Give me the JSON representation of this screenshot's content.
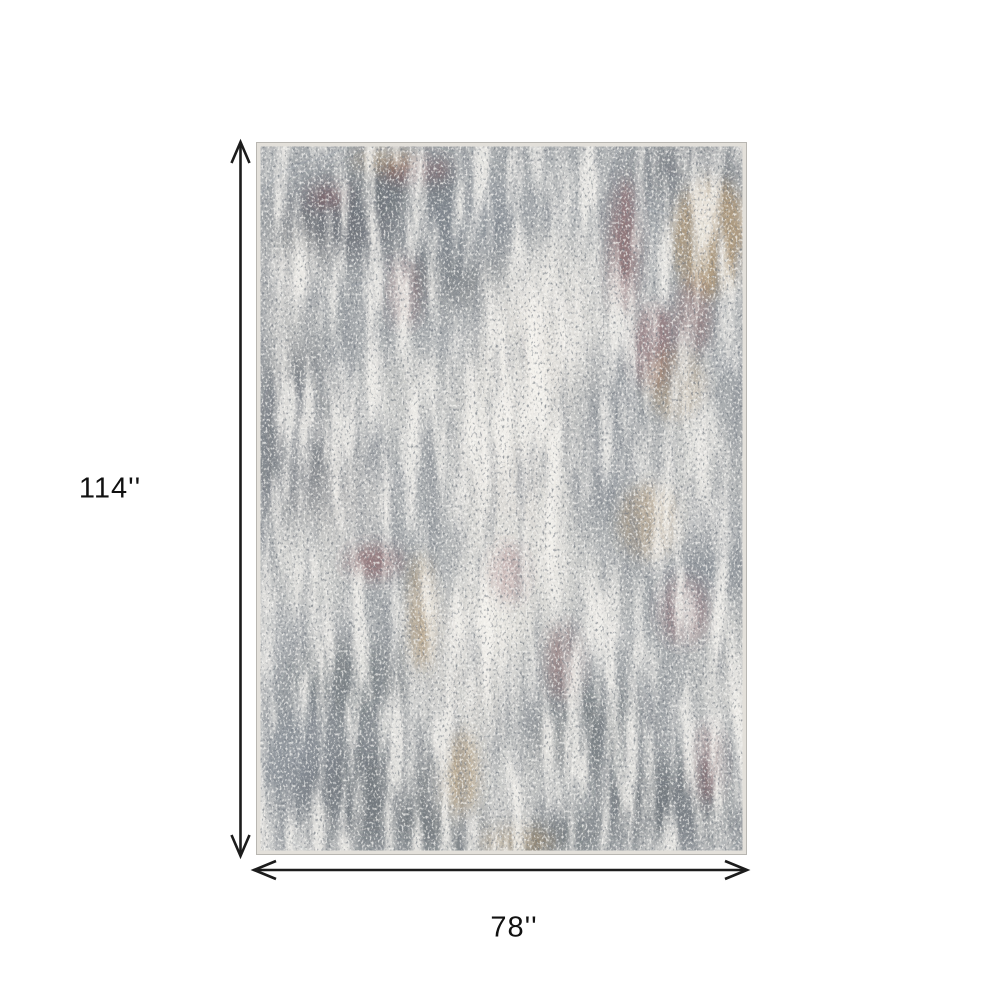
{
  "figure": {
    "type": "product-dimension-diagram",
    "subject": "abstract distressed area rug, gray and ivory with maroon and gold accents",
    "background": "#ffffff"
  },
  "dimensions": {
    "height_label": "114''",
    "width_label": "78''"
  },
  "palette": {
    "bg": "#ffffff",
    "line": "#1c1c1c",
    "text": "#111111",
    "rug_base": "#a4a8ab",
    "rug_ivory": "#eae7e1",
    "rug_charcoal": "#474d55",
    "rug_slate": "#707a86",
    "rug_maroon": "#7e4245",
    "rug_gold": "#b98f55",
    "rug_binding": "#e3e0da",
    "rug_edge": "#b8b6b1"
  }
}
